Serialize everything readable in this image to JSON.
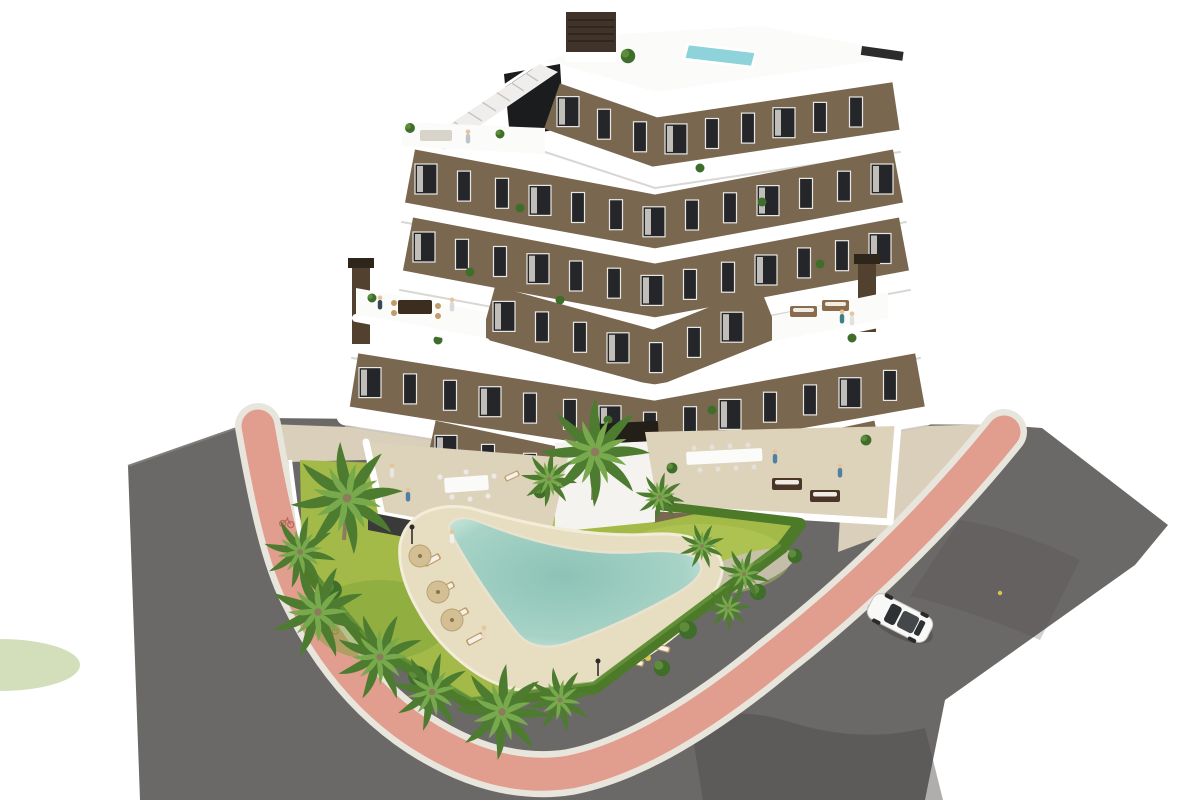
{
  "page": {
    "title": "Aerial 3D rendering of a new-build apartment complex with communal pool and gardens",
    "background": "#ffffff"
  },
  "scene": {
    "type": "architectural-3d-rendering",
    "view": "aerial-axonometric",
    "building": {
      "name": "chevron-apartment-block",
      "floors_visible": 7,
      "facade": "brown stucco with white wrap-around curved balcony bands",
      "features": [
        "rooftop plunge pool",
        "rooftop stair tower",
        "roof terraces with outdoor lounges",
        "two dark chimneys",
        "floor-to-ceiling windows with white curtains",
        "residents on terraces"
      ]
    },
    "grounds": {
      "features": [
        "free-form boomerang swimming pool",
        "sand-coloured pool deck",
        "timber sun loungers",
        "tan parasols",
        "lawn",
        "planted island bed",
        "palm trees",
        "perimeter hedge",
        "gravel planting beds",
        "outdoor dining terraces",
        "courtyard bar with stools",
        "lamp posts",
        "bathers and residents"
      ]
    },
    "surroundings": {
      "roads": [
        "asphalt street curving on the left",
        "asphalt street running diagonally on the right"
      ],
      "bike_lane": "pink cycle path wrapping the corner plot with white kerbs and painted bicycle symbols",
      "vehicle": "white saloon car driving on the right-hand street",
      "sidewalk": "beige pavement strips between cycle path and plot"
    }
  },
  "colors": {
    "white": "#ffffff",
    "wall": "#7a6750",
    "wallshade": "#66543f",
    "win": "#24262a",
    "frame": "#e9e7e3",
    "curtain": "#ddd9d2",
    "slab": "#ffffff",
    "slabshadow": "#c9c6c0",
    "roof": "#fbfbfa",
    "roofpool": "#8ed3da",
    "bulkhead": "#40342a",
    "stairs": "#efeeec",
    "glass": "#1a1c1e",
    "chimney": "#52412e",
    "chimneycap": "#2e251b",
    "terrace": "#ddd2ba",
    "terracedge": "#f4f1ea",
    "grass": "#a3ba49",
    "grasslight": "#bccf60",
    "grassdark": "#7fa23a",
    "hedge": "#4c7a28",
    "hedgedark": "#3a611e",
    "bush": "#3f6d2a",
    "bushlight": "#6f9c43",
    "palm": "#4d7c31",
    "palmlight": "#78a94c",
    "trunk": "#8d7b5e",
    "sand": "#e7ddc0",
    "sandedge": "#f2ecd9",
    "pool": "#a7d3c6",
    "pooldeep": "#8cc3b6",
    "pooledge": "#cde8dd",
    "road": "#6b6967",
    "roaddark": "#4e4c4a",
    "pink": "#e19d8d",
    "pinkdark": "#b96b5d",
    "curb": "#e8e5dc",
    "sidewalk": "#d9cfba",
    "carbody": "#f8f8f7",
    "carglass": "#2e3134",
    "woodfurn": "#c29b66",
    "darkfurn": "#3b2d20",
    "umbrella": "#d4bf94",
    "metal": "#55524e",
    "yellow": "#d9c84e",
    "skin": "#e8c49a",
    "blueperson": "#4f7fa6",
    "gravel": "#c9c2b0"
  }
}
